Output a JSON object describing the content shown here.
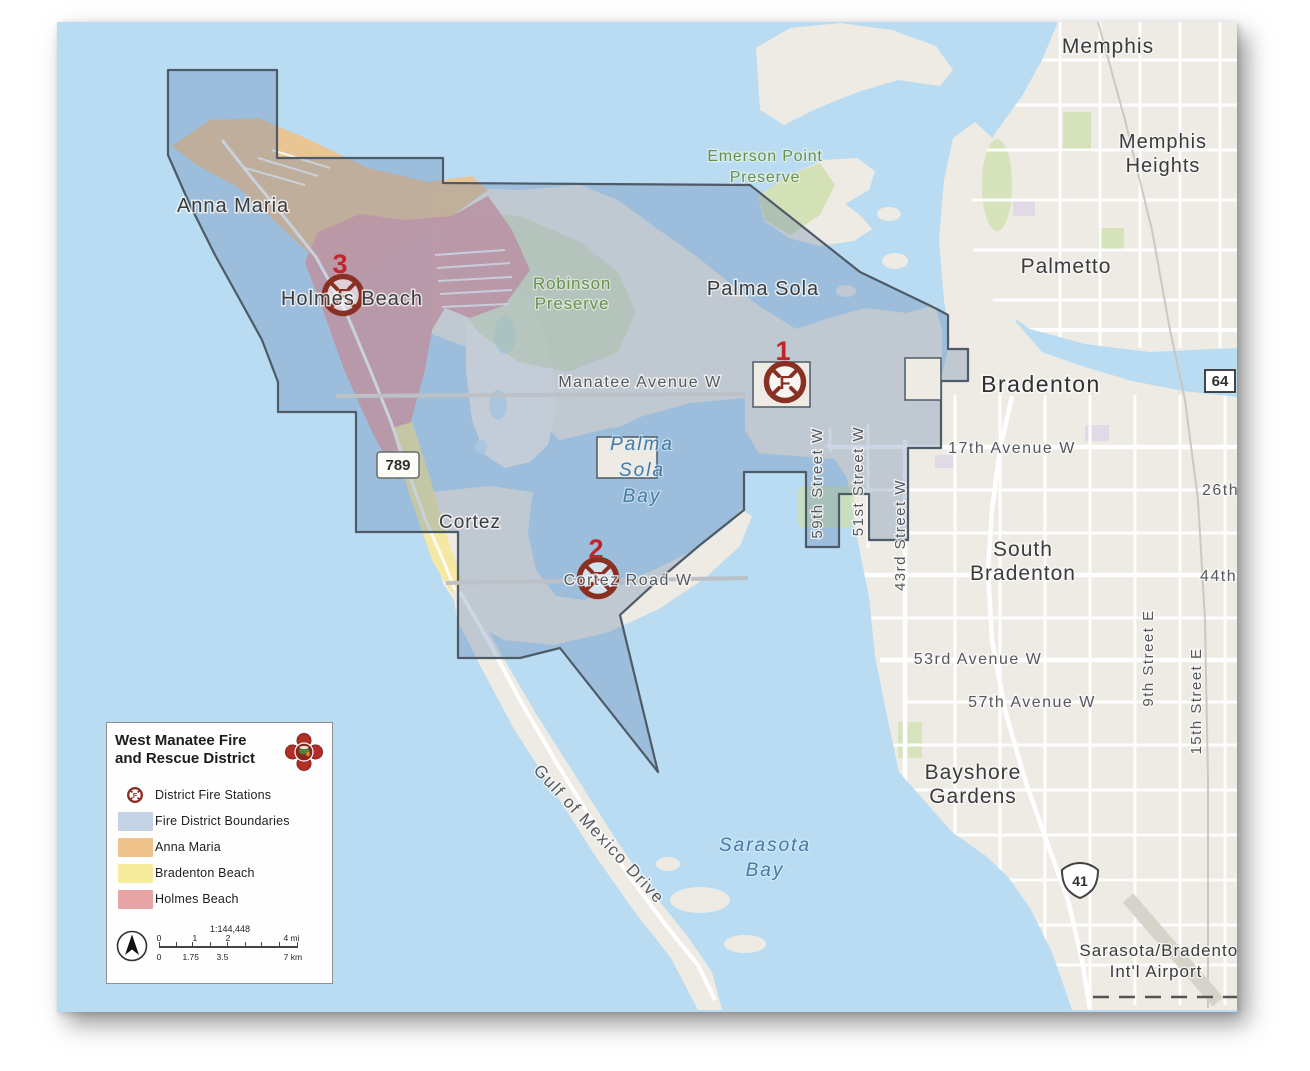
{
  "map_title": "West Manatee Fire and Rescue District",
  "colors": {
    "water": "#b9dcf3",
    "land": "#edebe3",
    "district_overlay": "#7fa0c8",
    "district_border": "#4e5a66",
    "anna_maria": "#eec28c",
    "bradenton_beach": "#f5e99e",
    "holmes_beach": "#e4a1a4",
    "station_marker": "#8a3023",
    "station_number": "#c2242b",
    "preserve_text": "#69904f",
    "water_text": "#4679a3",
    "road_text": "#55585c",
    "city_text": "#3c3c3c"
  },
  "legend": {
    "title_line1": "West Manatee Fire",
    "title_line2": "and Rescue District",
    "items": [
      {
        "label": "District Fire Stations",
        "swatch": "station-symbol"
      },
      {
        "label": "Fire District Boundaries",
        "swatch": "#c5d3e6"
      },
      {
        "label": "Anna Maria",
        "swatch": "#f0c38c"
      },
      {
        "label": "Bradenton Beach",
        "swatch": "#f7ec9e"
      },
      {
        "label": "Holmes Beach",
        "swatch": "#e7a4a4"
      }
    ],
    "scale": {
      "ratio": "1:144,448",
      "miles": [
        "0",
        "1",
        "2",
        "4 mi"
      ],
      "km": [
        "0",
        "1.75",
        "3.5",
        "7 km"
      ]
    }
  },
  "stations": [
    {
      "number": "1",
      "letter": "F"
    },
    {
      "number": "2",
      "letter": "F"
    },
    {
      "number": "3",
      "letter": "F"
    }
  ],
  "labels": {
    "cities": {
      "memphis": "Memphis",
      "memphis_heights_l1": "Memphis",
      "memphis_heights_l2": "Heights",
      "palmetto": "Palmetto",
      "bradenton": "Bradenton",
      "south_bradenton_l1": "South",
      "south_bradenton_l2": "Bradenton",
      "bayshore_l1": "Bayshore",
      "bayshore_l2": "Gardens",
      "airport_l1": "Sarasota/Bradenton",
      "airport_l2": "Int'l Airport",
      "anna_maria": "Anna Maria",
      "holmes_beach": "Holmes Beach",
      "cortez": "Cortez",
      "palma_sola": "Palma Sola"
    },
    "preserves": {
      "robinson_l1": "Robinson",
      "robinson_l2": "Preserve",
      "emerson_l1": "Emerson Point",
      "emerson_l2": "Preserve"
    },
    "water": {
      "palma_sola_bay_l1": "Palma",
      "palma_sola_bay_l2": "Sola",
      "palma_sola_bay_l3": "Bay",
      "sarasota_bay_l1": "Sarasota",
      "sarasota_bay_l2": "Bay"
    },
    "roads": {
      "manatee_ave": "Manatee Avenue W",
      "cortez_rd": "Cortez Road W",
      "ave17": "17th Avenue W",
      "ave53": "53rd Avenue W",
      "ave57": "57th Avenue W",
      "st59": "59th Street W",
      "st51": "51st Street W",
      "st43": "43rd Street W",
      "st9": "9th Street E",
      "st15": "15th Street E",
      "ave26": "26th",
      "ave44": "44th",
      "gulf_dr": "Gulf of Mexico Drive"
    },
    "shields": {
      "r789": "789",
      "r64": "64",
      "r41": "41"
    }
  }
}
